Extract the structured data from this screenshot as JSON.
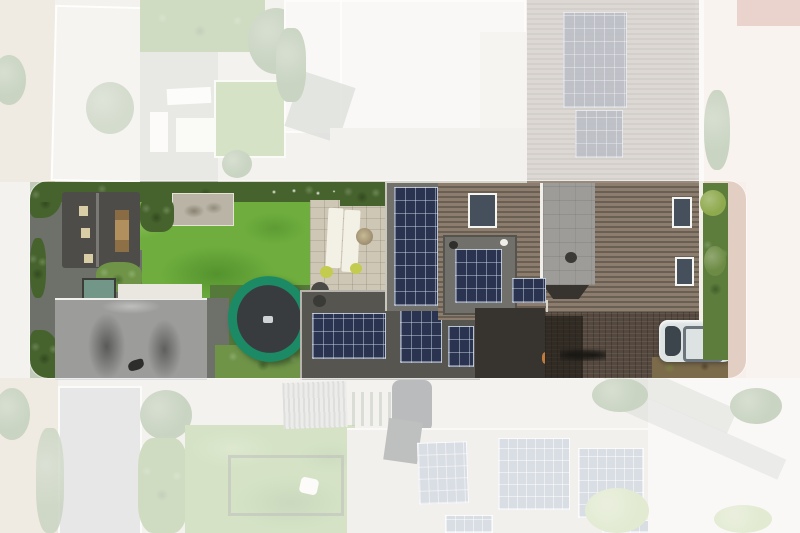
{
  "meta": {
    "type": "aerial-drone-photograph",
    "description": "Top-down aerial photo of a long residential parcel. The parcel is highlighted as a horizontal rounded band in full colour; all surrounding properties and the street are faded beneath a translucent white overlay.",
    "highlight_band": "rounded-rectangle spanning nearly full image width at mid-height",
    "visible_text": "none"
  },
  "palette": {
    "base_ground": "#d9d6cc",
    "fade_overlay": "rgba(255,255,255,0.67)",
    "grass": "#6fae3e",
    "hedge": "#47632d",
    "hedge_light": "#6f9448",
    "tree": "#5d7d46",
    "shed_roof": "#4e4c48",
    "shed_door": "#b2905e",
    "skylight": "#d9cda6",
    "pergola": "#b9b4a6",
    "patio": "#cfc7b5",
    "lounger": "#f3f0e6",
    "garage_roof": "#9c9c9a",
    "path_dark": "#6e716a",
    "apron_light": "#e9e7e0",
    "planter_teal": "#729789",
    "tramp_ring": "#1d8a66",
    "tramp_mat": "#393c3f",
    "flatroof_dark": "#57554f",
    "flatroof_mid": "#72706a",
    "panel_dark": "#2a3450",
    "panel_pale": "#8d98ac",
    "house_roof_a": "#8c7d6e",
    "house_roof_b": "#6a5f53",
    "slate_gray": "#9d9c98",
    "window_glass": "#46505c",
    "window_frame": "#f5f5f2",
    "brick_drive": "#55493f",
    "entry_dark": "#37342f",
    "car_body": "#dde2e3",
    "car_glass": "#3c444c",
    "car_dark": "#2e3236",
    "street_pink": "#ecd9cf",
    "street_tiles": "#c07b67",
    "pale_roof": "#eceae4",
    "pale_roof_2": "#dfdcd4",
    "neighbor_roof": "#d8d1c4",
    "gravel": "#cfc2a8",
    "lawn_far": "#7fa850",
    "brown_hedge": "#7c6b4b"
  },
  "regions": [
    {
      "name": "highlight-window",
      "label": "highlighted property parcel (rounded band, full colour)"
    },
    {
      "name": "street-right",
      "label": "street and pavement on right edge, faded pink"
    },
    {
      "name": "main-house-roof",
      "label": "large slatted roof of main house with roof windows"
    },
    {
      "name": "slate-dormer",
      "label": "grey slate chimney/dormer section on main roof"
    },
    {
      "name": "solar-array-tall",
      "label": "tall vertical solar array on flat roof"
    },
    {
      "name": "solar-array-dormer",
      "label": "solar array on roof dormer"
    },
    {
      "name": "solar-array-left",
      "label": "solar array on rear extension flat roof (left)"
    },
    {
      "name": "solar-array-mid",
      "label": "solar array on rear extension flat roof (middle)"
    },
    {
      "name": "solar-array-small",
      "label": "small solar array near house"
    },
    {
      "name": "garden-lawn",
      "label": "bright green artificial lawn"
    },
    {
      "name": "trampoline",
      "label": "green-rimmed trampoline with dark mat"
    },
    {
      "name": "garden-shed",
      "label": "dark-roofed garden shed with wooden doors"
    },
    {
      "name": "garage-roof",
      "label": "grey garage roof with dark weathering streaks"
    },
    {
      "name": "pergola",
      "label": "grey canopy/pergola at garden edge"
    },
    {
      "name": "patio-terrace",
      "label": "stone terrace with two white loungers and plants"
    },
    {
      "name": "parked-car-white",
      "label": "white/silver hatchback parked on driveway"
    },
    {
      "name": "parked-car-dark",
      "label": "dark car at neighbouring plot (faded)"
    },
    {
      "name": "neighbor-solar-roof",
      "label": "neighbouring roof with solar panels (faded, bottom)"
    },
    {
      "name": "neighbor-garden-top",
      "label": "neighbouring garden with benches and lawn (faded, top)"
    },
    {
      "name": "hedges",
      "label": "dense green boundary hedges along parcel edges"
    }
  ]
}
